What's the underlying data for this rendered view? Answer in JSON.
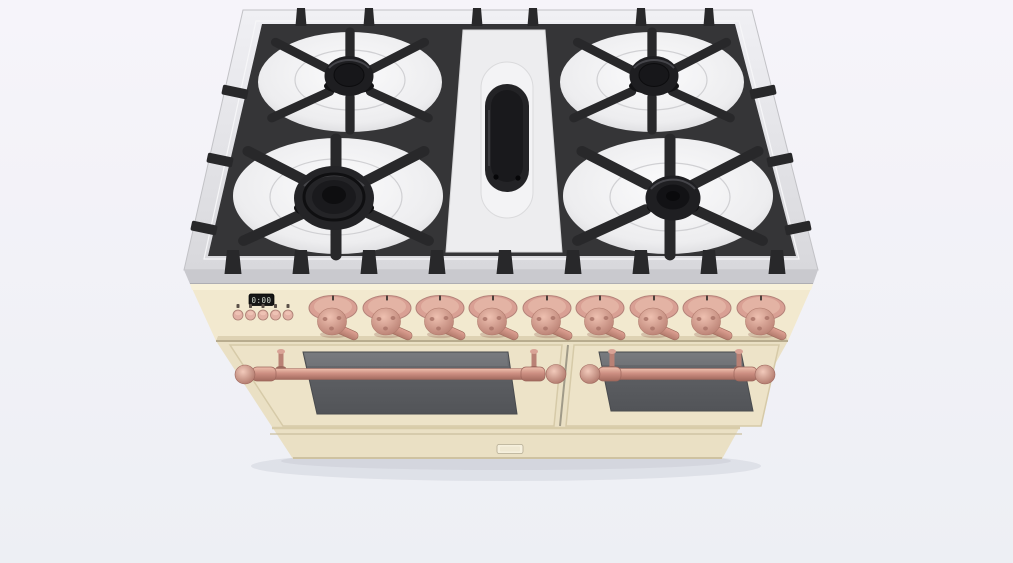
{
  "scene": {
    "type": "3d-product-render",
    "subject": "freestanding range cooker, top-front perspective view",
    "body_finish": "antique cream",
    "hardware_finish": "copper"
  },
  "cooktop": {
    "surface_material": "stainless-steel",
    "grate_material": "cast-iron",
    "burner_count": 5,
    "burners": [
      {
        "name": "rear-left",
        "style": "standard-cap"
      },
      {
        "name": "rear-right",
        "style": "standard-cap"
      },
      {
        "name": "front-left",
        "style": "wok-ring"
      },
      {
        "name": "front-right",
        "style": "standard-cap"
      },
      {
        "name": "center",
        "style": "oval-griddle-burner"
      }
    ]
  },
  "control_panel": {
    "display": {
      "value": "0:00"
    },
    "button_count": 5,
    "knob_count": 9
  },
  "oven": {
    "door_count": 2,
    "left_door": {
      "window": true,
      "handle": "copper rail with ball finials"
    },
    "right_door": {
      "window": true,
      "handle": "copper rail with ball finials"
    },
    "badge_text": ""
  },
  "colors": {
    "background": "#f6f4fa",
    "backgroundBottom": "#edeff4",
    "steelFace": "#c9c9ce",
    "grate": "#353537",
    "grateBar": "#28282a",
    "cap": "#1e1e21",
    "recess": "#ededef",
    "cream": "#f2e9cf",
    "creamFront": "#eae0c4",
    "creamDoor": "#ede3c8",
    "copper": "#d09488",
    "copperDark": "#a06c5e",
    "glass": "#595b5e",
    "displayBg": "#161616",
    "displayText": "#d6ded2",
    "badge": "#f6f0dd"
  }
}
